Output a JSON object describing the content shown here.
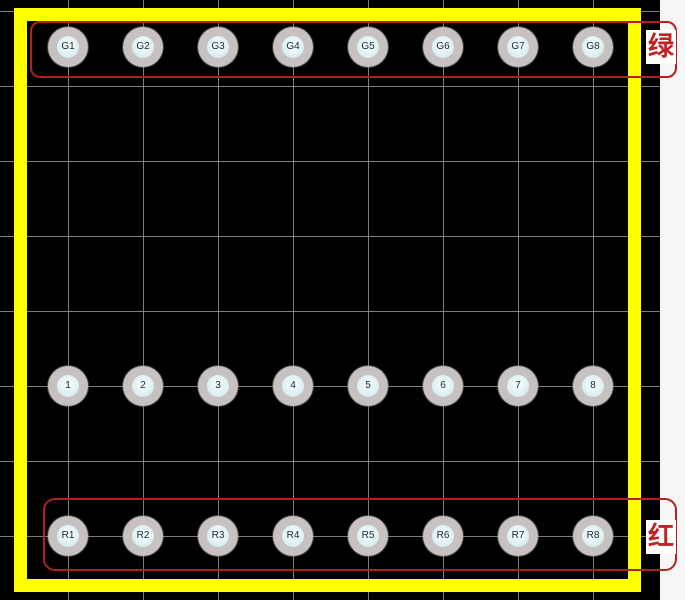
{
  "canvas": {
    "background_color": "#000000",
    "grid_color": "#7d7d7d",
    "margin_color": "#f6f6f6"
  },
  "board": {
    "outline_color": "#ffff00"
  },
  "pad_rows": [
    {
      "id": "green-row",
      "labels": [
        "G1",
        "G2",
        "G3",
        "G4",
        "G5",
        "G6",
        "G7",
        "G8"
      ]
    },
    {
      "id": "numbered-row",
      "labels": [
        "1",
        "2",
        "3",
        "4",
        "5",
        "6",
        "7",
        "8"
      ]
    },
    {
      "id": "red-row",
      "labels": [
        "R1",
        "R2",
        "R3",
        "R4",
        "R5",
        "R6",
        "R7",
        "R8"
      ]
    }
  ],
  "annotations": {
    "rect_color": "#b42020",
    "green": {
      "text": "绿",
      "text_color": "#c22222"
    },
    "red": {
      "text": "红",
      "text_color": "#c22222"
    }
  },
  "pad_style": {
    "outer_color": "#c7c1c1",
    "inner_color": "#d6ecf0",
    "label_color": "#1a2630"
  }
}
